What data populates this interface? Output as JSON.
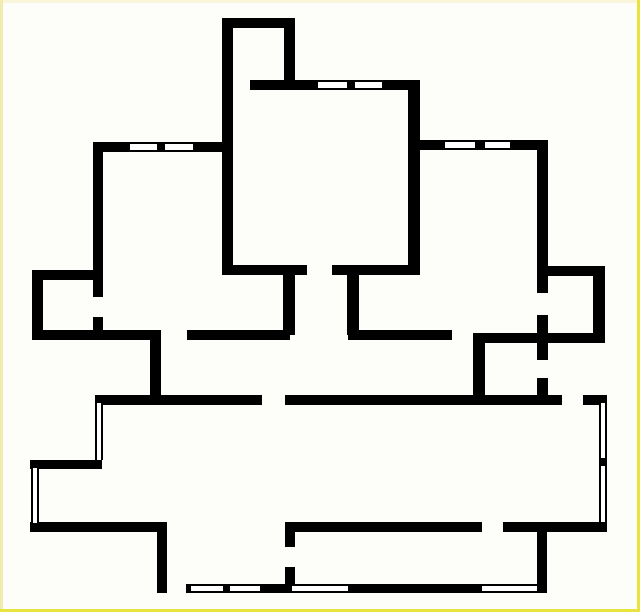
{
  "canvas": {
    "width": 640,
    "height": 612,
    "background_color": "#fdfdf9",
    "frame": {
      "thickness": 3,
      "top_color": "#f9f6dc",
      "left_color": "#f1ecae",
      "right_color": "#e9e340",
      "bottom_color": "#e9e340"
    }
  },
  "plan": {
    "wall_color": "#000000",
    "window_core_color": "#ffffff",
    "walls": [
      {
        "name": "top-room-top-wall",
        "x": 222,
        "y": 18,
        "w": 73,
        "h": 10
      },
      {
        "name": "top-room-left-wall",
        "x": 222,
        "y": 18,
        "w": 11,
        "h": 257
      },
      {
        "name": "top-room-right-wall",
        "x": 284,
        "y": 18,
        "w": 11,
        "h": 72
      },
      {
        "name": "upper-wall-left",
        "x": 250,
        "y": 80,
        "w": 68,
        "h": 10
      },
      {
        "name": "upper-wall-mullion",
        "x": 347,
        "y": 80,
        "w": 8,
        "h": 10
      },
      {
        "name": "upper-wall-right",
        "x": 382,
        "y": 80,
        "w": 38,
        "h": 10
      },
      {
        "name": "central-right-wall",
        "x": 408,
        "y": 80,
        "w": 12,
        "h": 195
      },
      {
        "name": "left-top-wall-a",
        "x": 93,
        "y": 142,
        "w": 37,
        "h": 10
      },
      {
        "name": "left-top-wall-mullion",
        "x": 157,
        "y": 142,
        "w": 8,
        "h": 10
      },
      {
        "name": "left-top-wall-b",
        "x": 193,
        "y": 142,
        "w": 40,
        "h": 10
      },
      {
        "name": "left-wall-upper",
        "x": 93,
        "y": 142,
        "w": 10,
        "h": 155
      },
      {
        "name": "left-wall-stub",
        "x": 93,
        "y": 317,
        "w": 10,
        "h": 23
      },
      {
        "name": "right-top-wall-a",
        "x": 410,
        "y": 140,
        "w": 35,
        "h": 10
      },
      {
        "name": "right-top-wall-mullion",
        "x": 475,
        "y": 140,
        "w": 10,
        "h": 10
      },
      {
        "name": "right-top-wall-b",
        "x": 510,
        "y": 140,
        "w": 38,
        "h": 10
      },
      {
        "name": "right-long-wall",
        "x": 537,
        "y": 140,
        "w": 11,
        "h": 153
      },
      {
        "name": "nook-top-wall",
        "x": 32,
        "y": 270,
        "w": 66,
        "h": 10
      },
      {
        "name": "nook-left-wall",
        "x": 32,
        "y": 270,
        "w": 11,
        "h": 70
      },
      {
        "name": "mid-wall-left",
        "x": 223,
        "y": 265,
        "w": 84,
        "h": 10
      },
      {
        "name": "mid-wall-right",
        "x": 332,
        "y": 265,
        "w": 84,
        "h": 10
      },
      {
        "name": "mid-post-left",
        "x": 283,
        "y": 275,
        "w": 12,
        "h": 60
      },
      {
        "name": "mid-post-right",
        "x": 347,
        "y": 275,
        "w": 12,
        "h": 60
      },
      {
        "name": "right-room-top-wall",
        "x": 538,
        "y": 266,
        "w": 67,
        "h": 10
      },
      {
        "name": "right-room-right-wall",
        "x": 593,
        "y": 266,
        "w": 12,
        "h": 77
      },
      {
        "name": "lower-wall-a",
        "x": 32,
        "y": 330,
        "w": 128,
        "h": 10
      },
      {
        "name": "step-wall-vert",
        "x": 150,
        "y": 330,
        "w": 11,
        "h": 70
      },
      {
        "name": "lower-wall-b",
        "x": 187,
        "y": 330,
        "w": 103,
        "h": 10
      },
      {
        "name": "lower-wall-c",
        "x": 348,
        "y": 330,
        "w": 104,
        "h": 10
      },
      {
        "name": "lower-wall-d",
        "x": 473,
        "y": 333,
        "w": 129,
        "h": 10
      },
      {
        "name": "wc-left-wall",
        "x": 473,
        "y": 333,
        "w": 12,
        "h": 70
      },
      {
        "name": "mid-vert-upper",
        "x": 537,
        "y": 315,
        "w": 11,
        "h": 45
      },
      {
        "name": "mid-vert-lower",
        "x": 537,
        "y": 378,
        "w": 11,
        "h": 25
      },
      {
        "name": "hall-wall-left",
        "x": 95,
        "y": 395,
        "w": 167,
        "h": 10
      },
      {
        "name": "hall-wall-mid",
        "x": 285,
        "y": 395,
        "w": 277,
        "h": 10
      },
      {
        "name": "hall-wall-right",
        "x": 583,
        "y": 395,
        "w": 24,
        "h": 10
      },
      {
        "name": "step2-wall",
        "x": 30,
        "y": 460,
        "w": 72,
        "h": 9
      },
      {
        "name": "step3-wall",
        "x": 30,
        "y": 522,
        "w": 137,
        "h": 10
      },
      {
        "name": "bottom-left-vert-wall",
        "x": 157,
        "y": 532,
        "w": 10,
        "h": 61
      },
      {
        "name": "bottom-mid-wall-a",
        "x": 285,
        "y": 522,
        "w": 197,
        "h": 10
      },
      {
        "name": "bottom-mid-wall-b",
        "x": 503,
        "y": 522,
        "w": 104,
        "h": 10
      },
      {
        "name": "strip-post-upper",
        "x": 285,
        "y": 522,
        "w": 10,
        "h": 25
      },
      {
        "name": "strip-post-lower",
        "x": 285,
        "y": 567,
        "w": 10,
        "h": 26
      },
      {
        "name": "strip-right-wall",
        "x": 537,
        "y": 532,
        "w": 10,
        "h": 61
      },
      {
        "name": "bottom-wall-cap",
        "x": 186,
        "y": 584,
        "w": 5,
        "h": 9
      },
      {
        "name": "bottom-wall-mullion",
        "x": 223,
        "y": 584,
        "w": 7,
        "h": 9
      },
      {
        "name": "bottom-wall-solid-a",
        "x": 260,
        "y": 584,
        "w": 32,
        "h": 9
      },
      {
        "name": "bottom-wall-solid-b",
        "x": 348,
        "y": 584,
        "w": 134,
        "h": 9
      },
      {
        "name": "right-window-mullion",
        "x": 599,
        "y": 458,
        "w": 8,
        "h": 8
      }
    ],
    "windows": [
      {
        "name": "upper-window-1",
        "x": 318,
        "y": 80,
        "w": 29,
        "h": 10,
        "orientation": "h"
      },
      {
        "name": "upper-window-2",
        "x": 355,
        "y": 80,
        "w": 27,
        "h": 10,
        "orientation": "h"
      },
      {
        "name": "left-top-window-1",
        "x": 130,
        "y": 142,
        "w": 27,
        "h": 10,
        "orientation": "h"
      },
      {
        "name": "left-top-window-2",
        "x": 165,
        "y": 142,
        "w": 28,
        "h": 10,
        "orientation": "h"
      },
      {
        "name": "right-top-window-1",
        "x": 445,
        "y": 140,
        "w": 30,
        "h": 10,
        "orientation": "h"
      },
      {
        "name": "right-top-window-2",
        "x": 485,
        "y": 140,
        "w": 25,
        "h": 10,
        "orientation": "h"
      },
      {
        "name": "bottom-window-1",
        "x": 191,
        "y": 584,
        "w": 32,
        "h": 9,
        "orientation": "h"
      },
      {
        "name": "bottom-window-2",
        "x": 230,
        "y": 584,
        "w": 30,
        "h": 9,
        "orientation": "h"
      },
      {
        "name": "bottom-window-3",
        "x": 292,
        "y": 584,
        "w": 56,
        "h": 9,
        "orientation": "h"
      },
      {
        "name": "bottom-window-4",
        "x": 482,
        "y": 584,
        "w": 55,
        "h": 9,
        "orientation": "h"
      },
      {
        "name": "left-window-1",
        "x": 95,
        "y": 403,
        "w": 8,
        "h": 57,
        "orientation": "v"
      },
      {
        "name": "left-window-2",
        "x": 31,
        "y": 468,
        "w": 8,
        "h": 55,
        "orientation": "v"
      },
      {
        "name": "right-window-1",
        "x": 599,
        "y": 403,
        "w": 8,
        "h": 55,
        "orientation": "v"
      },
      {
        "name": "right-window-2",
        "x": 599,
        "y": 466,
        "w": 8,
        "h": 56,
        "orientation": "v"
      }
    ]
  }
}
